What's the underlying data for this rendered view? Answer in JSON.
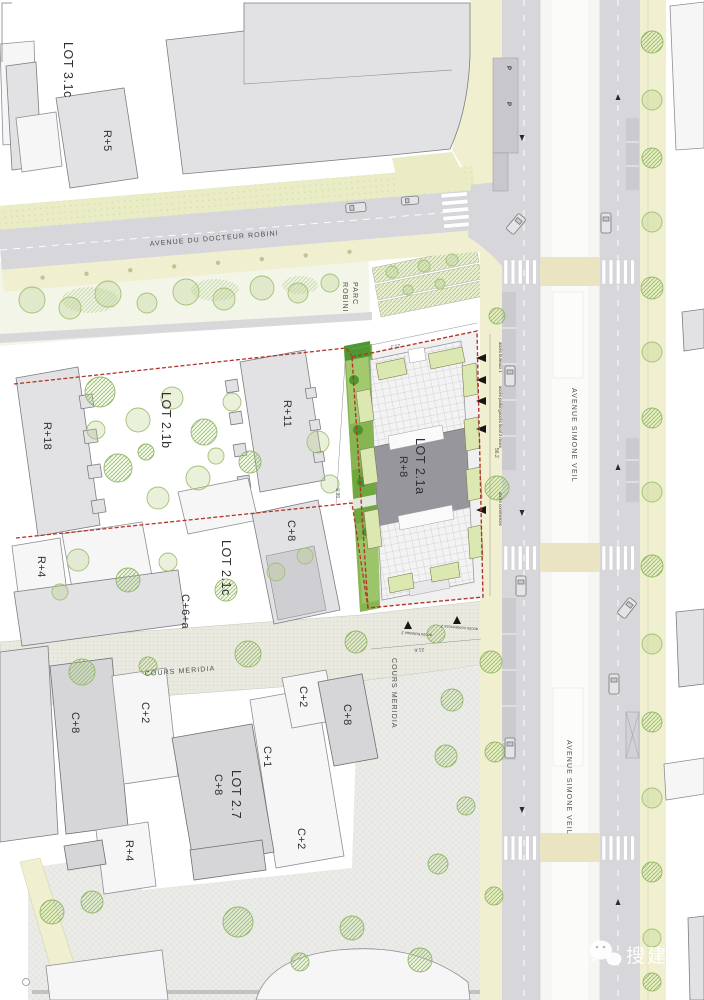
{
  "plan": {
    "streets": {
      "avenue_docteur_robini": "AVENUE DU DOCTEUR ROBINI",
      "avenue_simone_veil": "AVENUE SIMONE VEIL",
      "cours_meridia": "COURS MERIDIA",
      "parc_robini_line1": "PARC",
      "parc_robini_line2": "ROBINI"
    },
    "lots": {
      "lot_3_1c": "LOT 3.1c",
      "lot_2_1a": "LOT 2.1a",
      "lot_2_1b": "LOT 2.1b",
      "lot_2_1c": "LOT 2.1c",
      "lot_2_7": "LOT 2.7"
    },
    "heights": {
      "r5": "R+5",
      "r18": "R+18",
      "r11": "R+11",
      "r8": "R+8",
      "r4_north": "R+4",
      "r4_south": "R+4",
      "c8_lot21c": "C+8",
      "c6a": "C+6+a",
      "c8_west": "C+8",
      "c2_west": "C+2",
      "c2_north": "C+2",
      "c8_east": "C+8",
      "c1": "C+1",
      "c8_lot27": "C+8",
      "c2_south": "C+2"
    },
    "dimensions": {
      "north": "21.3",
      "west": "56.8",
      "south": "21.6",
      "east": "56.2"
    },
    "access_labels": {
      "bureaux1": "accès bureaux 1",
      "parking": "accès parking",
      "velos": "accès local 2 roues",
      "commerces": "accès commerces",
      "bureaux2": "accès bureaux 2",
      "commerces2": "accès commerces 2"
    },
    "parking_sign": "P",
    "watermark": "搜建筑"
  },
  "colors": {
    "lot_boundary_red": "#b43527",
    "building_gray": "#dadade",
    "building_core_gray": "#96969c",
    "road_gray": "#d7d7db",
    "sidewalk_yellow": "#f0efcf",
    "garden_green": "#86b551",
    "tree_green": "#9cc268",
    "median_white": "#f6f6f4"
  }
}
